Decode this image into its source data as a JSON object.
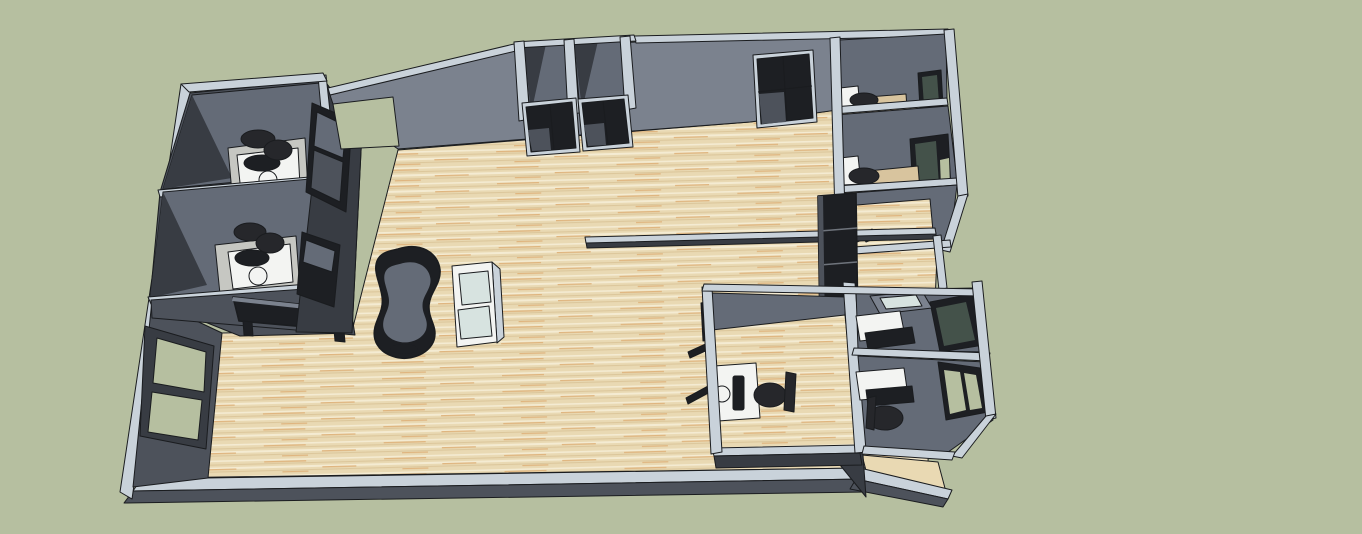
{
  "meta": {
    "app": "3d-floor-plan-render",
    "description": "Isometric 3D rendering of an office floor plan with furnished rooms, wood flooring, gray walls, doors and windows on a sage green background",
    "canvas": {
      "width": 1362,
      "height": 534
    }
  },
  "colors": {
    "bg": "#b6bfa0",
    "band": "#c9d2da",
    "f1": "#7b828e",
    "f2": "#646b77",
    "f3": "#4d525b",
    "f4": "#383c43",
    "dark": "#1d1f23",
    "glassTeal": "#d7e3e0",
    "glassDarkTeal": "#44524a",
    "white": "#f3f4f2",
    "lightFloor": "#c6c7c2",
    "deskTan": "#d8c49e",
    "chair": "#26272b",
    "floorBase": "#e9d9b3",
    "streakLight": "#f4ebd2",
    "streakDark": "#dcc79c",
    "streakOrange": "#dfb57f",
    "outline": "#1a1c1f"
  },
  "scene": {
    "objects": [
      {
        "id": "open-office-floor",
        "label": "Main open office area with wood plank floor"
      },
      {
        "id": "office-nw-1",
        "label": "Northwest office with white desk, round table and black chair"
      },
      {
        "id": "office-nw-2",
        "label": "Second northwest office with white desk, round table and black chair"
      },
      {
        "id": "glass-coffee-table",
        "label": "Black glass table against south face of northwest offices"
      },
      {
        "id": "west-window",
        "label": "Two-pane window in west wall"
      },
      {
        "id": "north-doorway",
        "label": "Open doorway in north wall"
      },
      {
        "id": "closet-rooms",
        "label": "Two small framed rooms on north wall"
      },
      {
        "id": "north-doors",
        "label": "Two dark glazed doors below closet rooms"
      },
      {
        "id": "north-double-door",
        "label": "Dark double door on north wall"
      },
      {
        "id": "bean-sofa",
        "label": "Kidney/bean shaped dark lounge seat"
      },
      {
        "id": "display-cabinet",
        "label": "White display cabinet with two glass panels"
      },
      {
        "id": "ne-office-1",
        "label": "Northeast office with desk, chair and window"
      },
      {
        "id": "ne-office-2",
        "label": "Second northeast office with desk, chair and window"
      },
      {
        "id": "ne-office-3",
        "label": "Third northeast room with wood floor"
      },
      {
        "id": "half-wall-counter",
        "label": "Low half wall / counter in center east"
      },
      {
        "id": "tall-dark-cabinet",
        "label": "Tall dark shelving cabinet on east wall"
      },
      {
        "id": "corridor-east",
        "label": "East corridor with wood floor"
      },
      {
        "id": "se-office-large",
        "label": "Large southeast office with computer desk and chair"
      },
      {
        "id": "se-office-a",
        "label": "Southeast office A with desk, monitor and tray table"
      },
      {
        "id": "se-office-b",
        "label": "Southeast office B with desk, monitor, chair and window"
      },
      {
        "id": "wall-shelf-brackets",
        "label": "Small wall-mounted brackets outside southeast office"
      }
    ]
  }
}
